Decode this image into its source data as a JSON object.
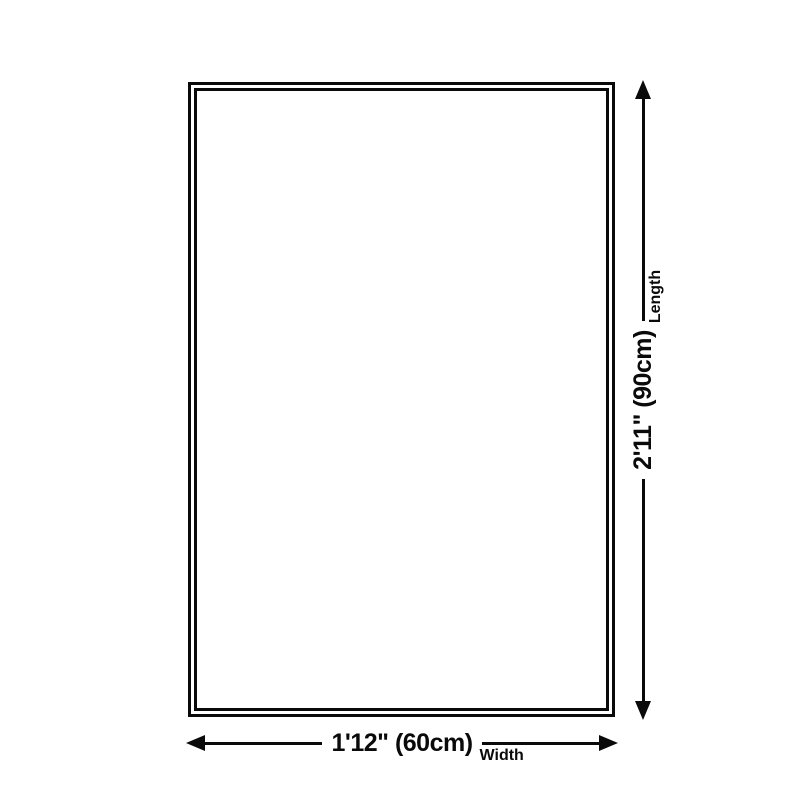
{
  "page": {
    "background": "#ffffff",
    "line_color": "#0a0a0a"
  },
  "product_outline": {
    "style": "double-border rectangle"
  },
  "dimensions": {
    "width": {
      "value": "1'12\" (60cm)",
      "label": "Width"
    },
    "length": {
      "value": "2'11\" (90cm)",
      "label": "Length"
    }
  }
}
